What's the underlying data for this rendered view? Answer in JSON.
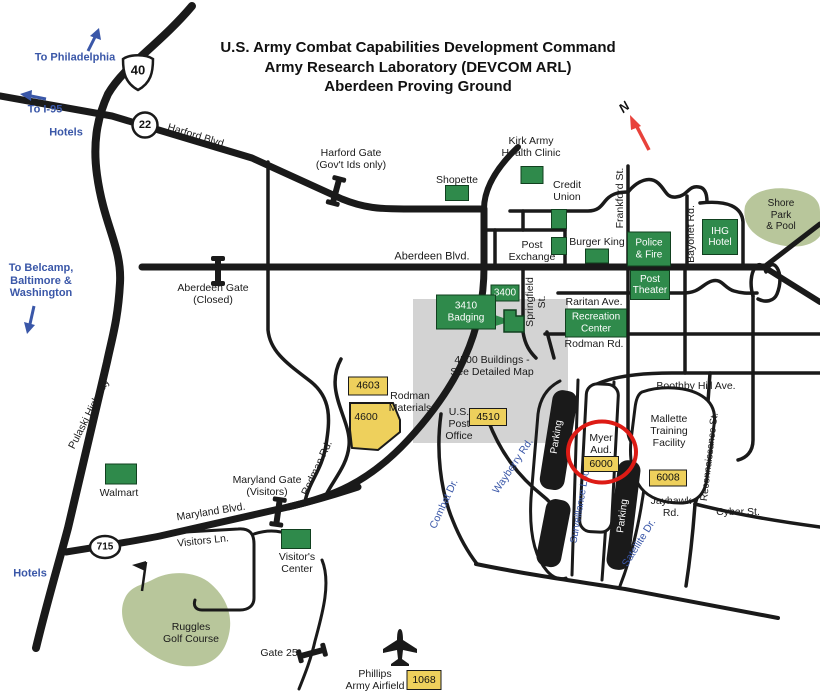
{
  "colors": {
    "facility_green": "#2f8a4b",
    "building_yellow": "#eed05c",
    "park_olive": "#b8c69b",
    "detail_gray": "#d3d3d3",
    "highlight_red": "#dd1b15",
    "wayfinding_blue": "#3a57a8",
    "road_black": "#1a1a1a"
  },
  "title": {
    "line1": "U.S. Army Combat Capabilities Development Command",
    "line2": "Army Research Laboratory (DEVCOM ARL)",
    "line3": "Aberdeen Proving Ground"
  },
  "compass": {
    "north": "N"
  },
  "shields": {
    "us40": "40",
    "md22": "22",
    "md715": "715"
  },
  "directions": {
    "philadelphia": "To Philadelphia",
    "i95": "To I-95",
    "hotels_top": "Hotels",
    "belcamp": "To Belcamp,\nBaltimore &\nWashington",
    "hotels_bottom": "Hotels"
  },
  "gates": {
    "harford": "Harford Gate\n(Gov't Ids only)",
    "aberdeen": "Aberdeen Gate\n(Closed)",
    "maryland": "Maryland Gate\n(Visitors)",
    "gate25": "Gate 25"
  },
  "streets": {
    "harford_blvd": "Harford Blvd.",
    "aberdeen_blvd": "Aberdeen Blvd.",
    "pulaski_highway": "Pulaski Highway",
    "maryland_blvd": "Maryland Blvd.",
    "visitors_ln": "Visitors Ln.",
    "springfield_st": "Springfield\nSt.",
    "frankford_st": "Frankford St.",
    "bayonet_rd": "Bayonet Rd.",
    "raritan_ave": "Raritan Ave.",
    "rodman_rd": "Rodman Rd.",
    "boothby_hill_ave": "Boothby Hill Ave.",
    "reconnaissance_st": "Reconnaissance St.",
    "jayhawk_rd": "Jayhawk\nRd.",
    "cyber_st": "Cyber St.",
    "combat_dr": "Combat Dr.",
    "wayberry_rd": "Wayberry Rd.",
    "surveillance_loop": "Surveillance Loop",
    "satellite_dr": "Satellite Dr."
  },
  "places": {
    "kirk_clinic": "Kirk Army\nHealth Clinic",
    "shopette": "Shopette",
    "credit_union": "Credit\nUnion",
    "post_exchange": "Post\nExchange",
    "burger_king": "Burger King",
    "police_fire": "Police\n& Fire",
    "post_theater": "Post\nTheater",
    "ihg_hotel": "IHG\nHotel",
    "shore_park": "Shore Park\n& Pool",
    "recreation_center": "Recreation\nCenter",
    "badging": "3410\nBadging",
    "bldg_3400": "3400",
    "bldg_4500_note": "4500 Buildings -\nSee Detailed Map",
    "bldg_4603": "4603",
    "bldg_4600": "4600",
    "rodman_materials": "Rodman\nMaterials",
    "us_post_office": "U.S.\nPost\nOffice",
    "bldg_4510": "4510",
    "myer_aud": "Myer\nAud.",
    "bldg_6000": "6000",
    "mallette": "Mallette\nTraining\nFacility",
    "bldg_6008": "6008",
    "parking": "Parking",
    "walmart": "Walmart",
    "visitor_center": "Visitor's\nCenter",
    "ruggles": "Ruggles\nGolf Course",
    "phillips_airfield": "Phillips\nArmy Airfield",
    "bldg_1068": "1068"
  }
}
